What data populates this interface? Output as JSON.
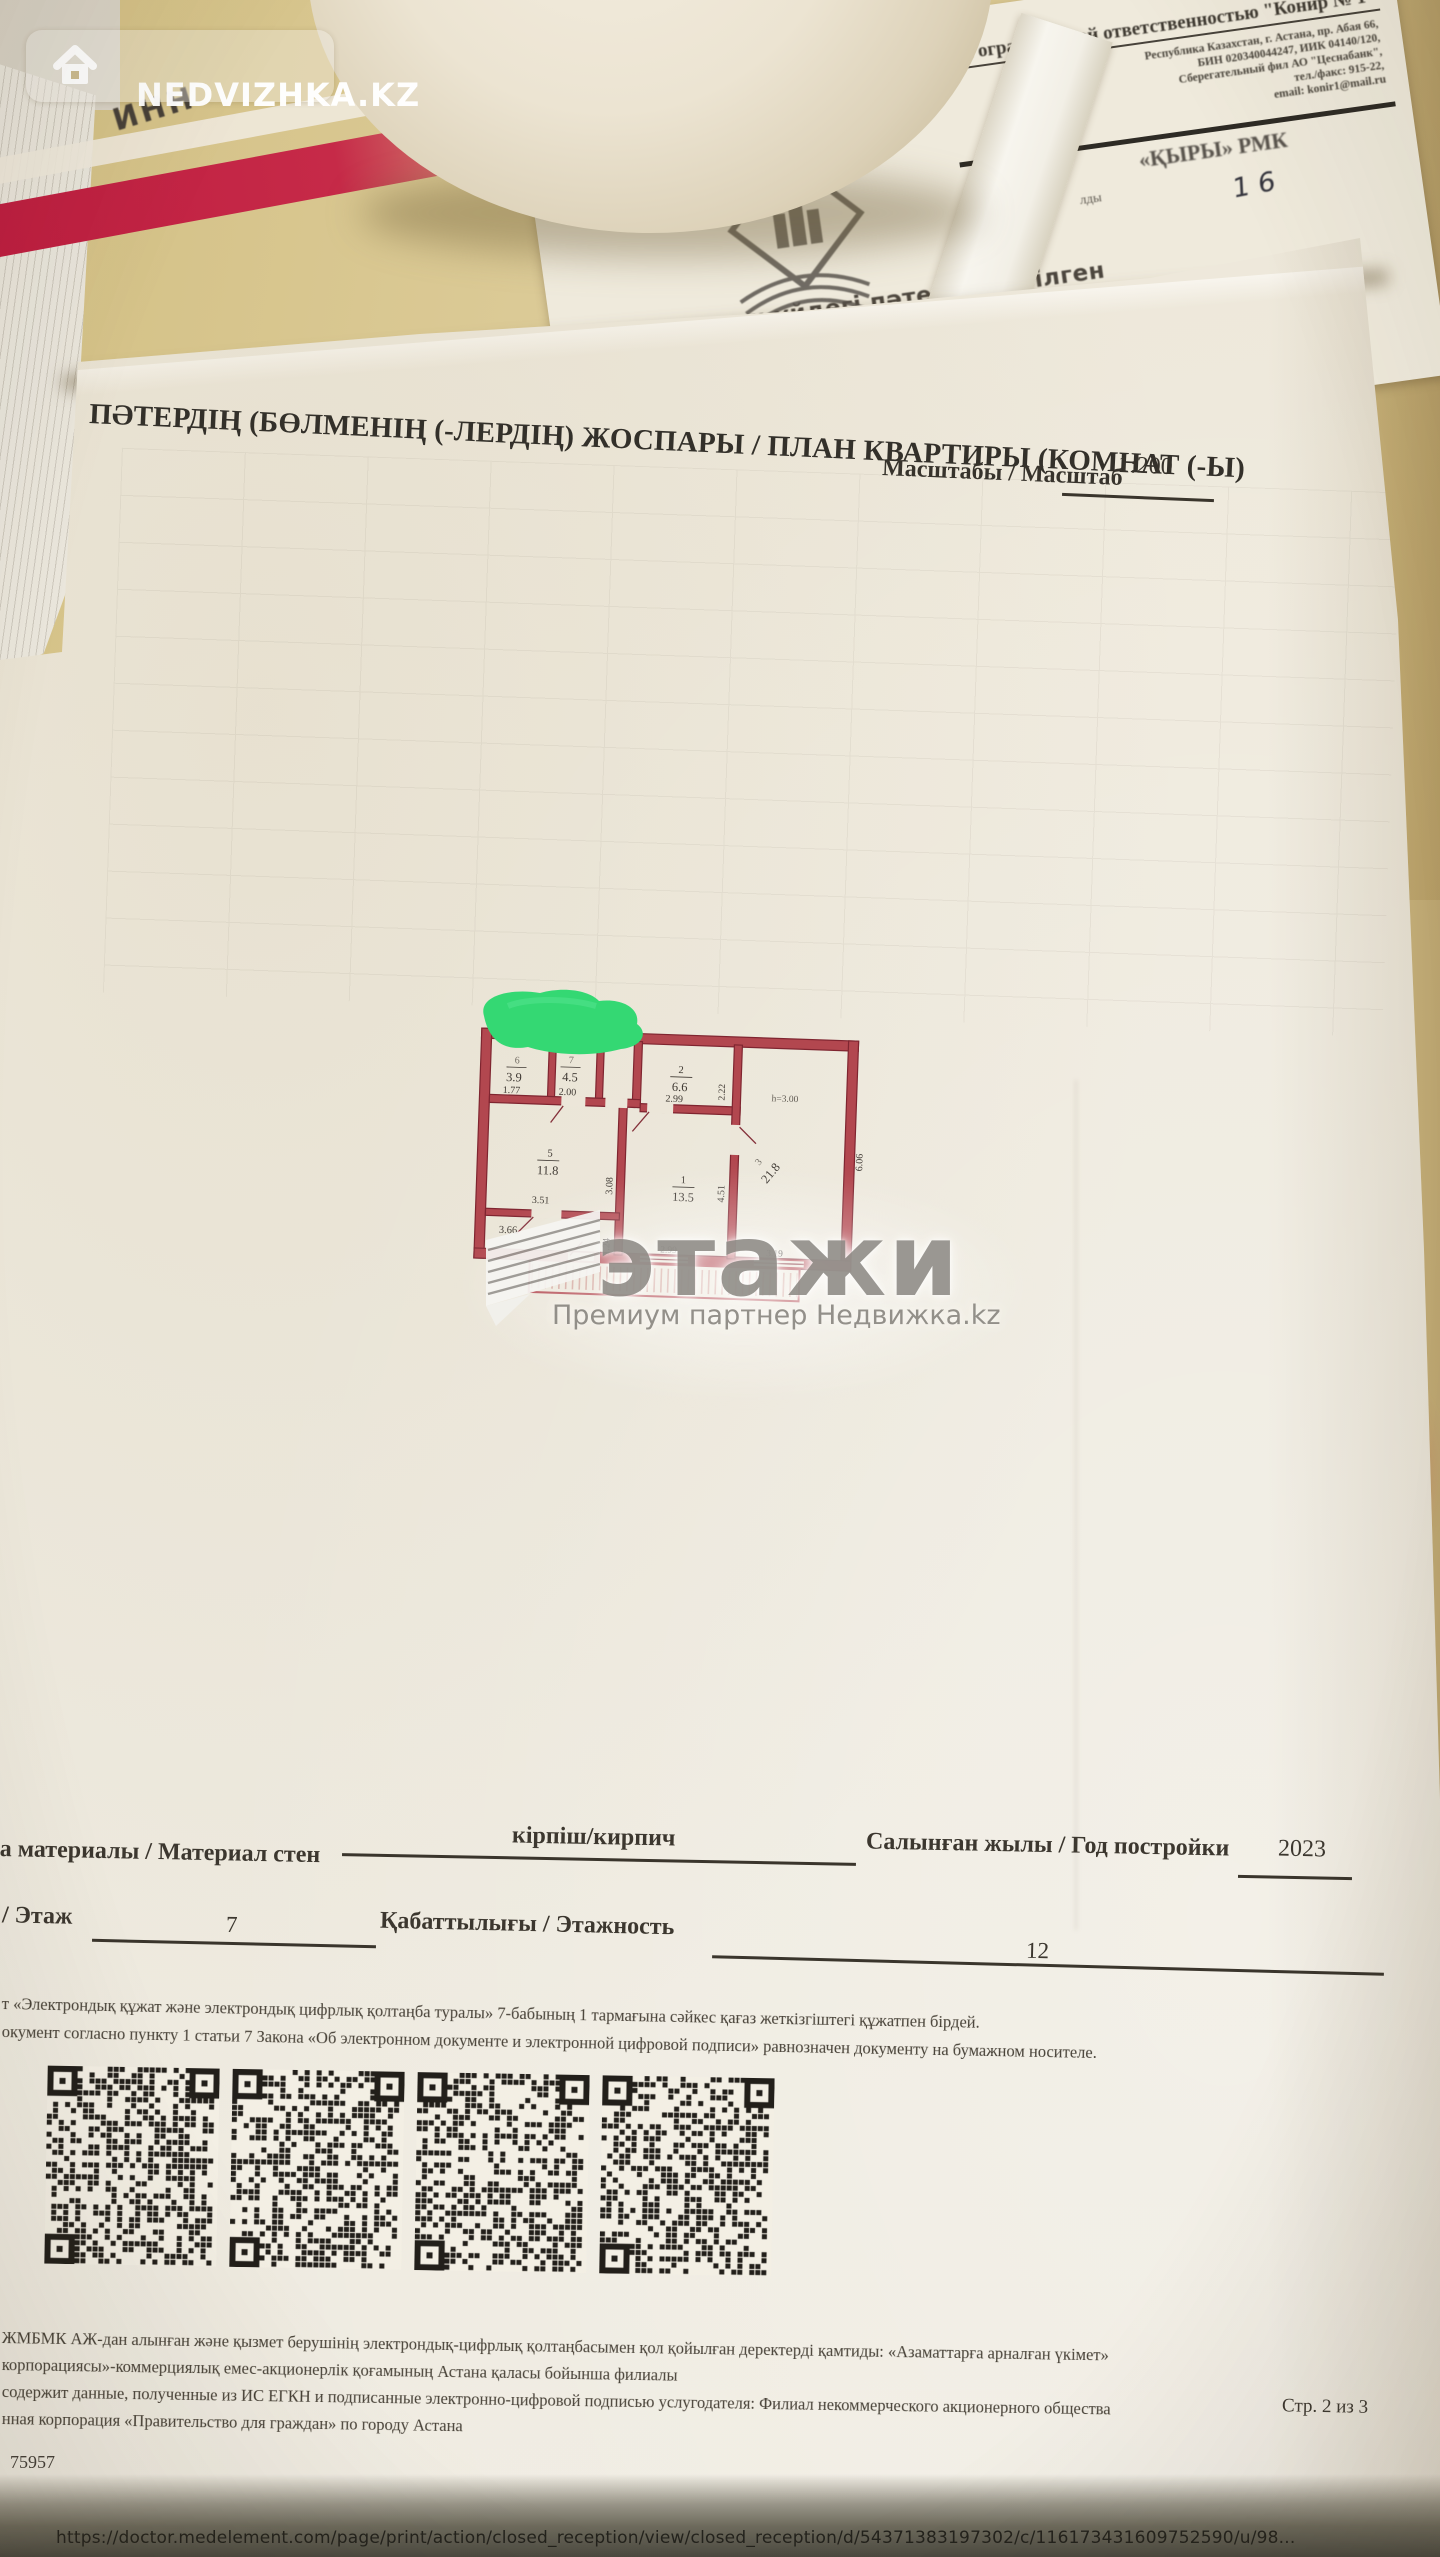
{
  "overlay": {
    "brand": "NEDVIZHKA.KZ",
    "etazhi_logo": "этажи",
    "etazhi_partner": "Премиум партнер Недвижка.kz"
  },
  "desk": {
    "inn_note": "ИНН"
  },
  "doc2": {
    "company": "Товарищество с ограниченной ответственностью \"Конир № 1\"",
    "addr1": "Республика Казахстан, г. Астана, пр. Абая 66,",
    "addr2": "БИН 020340044247, ИИК 04140/120,",
    "addr3": "Сберегательный фил АО \"Цеснабанк\",",
    "addr4": "тел./факс: 915-22,",
    "addr5": "email: konir1@mail.ru",
    "fragment_rmk": "«ҚЫРЫ» РМК",
    "fragment_ldy": "лды",
    "handwritten": "1 6",
    "title_kk": "тұрғын үйдегі пәтерге берілген",
    "title_ru": "/ПАСПОРТ",
    "fragment_dome": "доме"
  },
  "page": {
    "title": "ПӘТЕРДІҢ (БӨЛМЕНІҢ (-ЛЕРДІҢ) ЖОСПАРЫ / ПЛАН КВАРТИРЫ (КОМНАТ (-Ы)",
    "scale_label": "Масштабы / Масштаб",
    "scale_value": "1:200",
    "materials_label": "а материалы / Материал стен",
    "materials_value": "кірпіш/кирпич",
    "year_label": "Салынған жылы / Год постройки",
    "year_value": "2023",
    "floor_label": "/ Этаж",
    "floor_value": "7",
    "floors_label": "Қабаттылығы / Этажность",
    "floors_value": "12",
    "legal_kk": "т «Электрондық құжат және электрондық цифрлық қолтаңба туралы» 7-бабының 1 тармағына сәйкес қағаз жеткізгіштегі құжатпен бірдей.",
    "legal_ru": "окумент согласно пункту 1 статьи 7 Закона «Об электронном документе и электронной цифровой подписи» равнозначен документу на бумажном носителе.",
    "legal2_1": "ЖМБМК АЖ-дан алынған және қызмет берушінің электрондық-цифрлық қолтаңбасымен қол қойылған деректерді қамтиды: «Азаматтарға арналған үкімет»",
    "legal2_2": "корпорациясы»-коммерциялық емес-акционерлік қоғамының Астана қаласы бойынша филиалы",
    "legal2_3": "содержит данные, полученные из ИС ЕГКН и подписанные электронно-цифровой подписью услугодателя: Филиал некоммерческого акционерного общества",
    "legal2_4": "нная корпорация «Правительство для граждан» по городу Астана",
    "page_number": "Стр. 2 из 3",
    "doc_number": "75957"
  },
  "plan_labels": {
    "r6_num": "6",
    "r6_area": "3.9",
    "r6_w": "1.77",
    "r7_num": "7",
    "r7_area": "4.5",
    "r7_w": "2.00",
    "r2_num": "2",
    "r2_area": "6.6",
    "r2_w": "2.99",
    "r2_d": "2.22",
    "r3_num": "3",
    "r3_area": "21.8",
    "r3_d": "6.06",
    "height_note": "h=3.00",
    "r1_num": "1",
    "r1_area": "13.5",
    "r1_d": "4.51",
    "r5_num": "5",
    "r5_area": "11.8",
    "r5_w": "3.51",
    "r5_d": "3.08",
    "hall_w": "3.66",
    "hall_d": "1.24",
    "win1": "2.99",
    "win2": "3.19"
  },
  "footer": {
    "url": "https://doctor.medelement.com/page/print/action/closed_reception/view/closed_reception/d/54371383197302/c/116173431609752590/u/98..."
  },
  "colors": {
    "wall_red": "#b2474f",
    "green_marker": "#34d873",
    "paper": "#eee9dd",
    "desk": "#d5c28b"
  }
}
